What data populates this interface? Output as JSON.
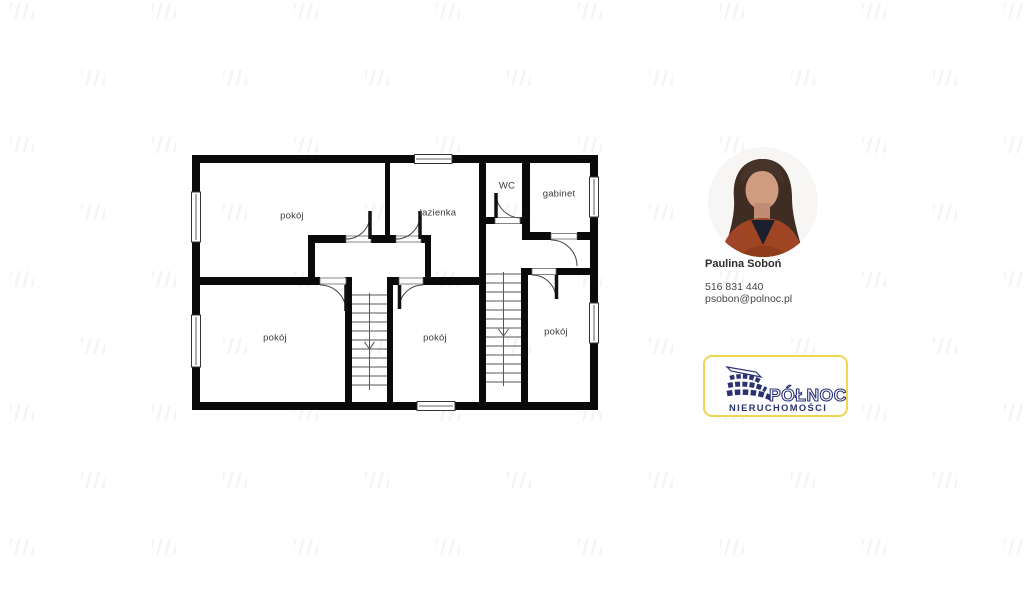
{
  "agent": {
    "name": "Paulina Soboń",
    "phone": "516 831 440",
    "email": "psobon@polnoc.pl"
  },
  "brand": {
    "logo_text": "PÓŁNOC",
    "logo_subtext": "NIERUCHOMOŚCI",
    "navy": "#2a3274",
    "yellow": "#eed653"
  },
  "floorplan": {
    "rooms": [
      {
        "label": "pokój"
      },
      {
        "label": "łazienka"
      },
      {
        "label": "WC"
      },
      {
        "label": "gabinet"
      },
      {
        "label": "pokój"
      },
      {
        "label": "pokój"
      },
      {
        "label": "pokój"
      }
    ]
  }
}
